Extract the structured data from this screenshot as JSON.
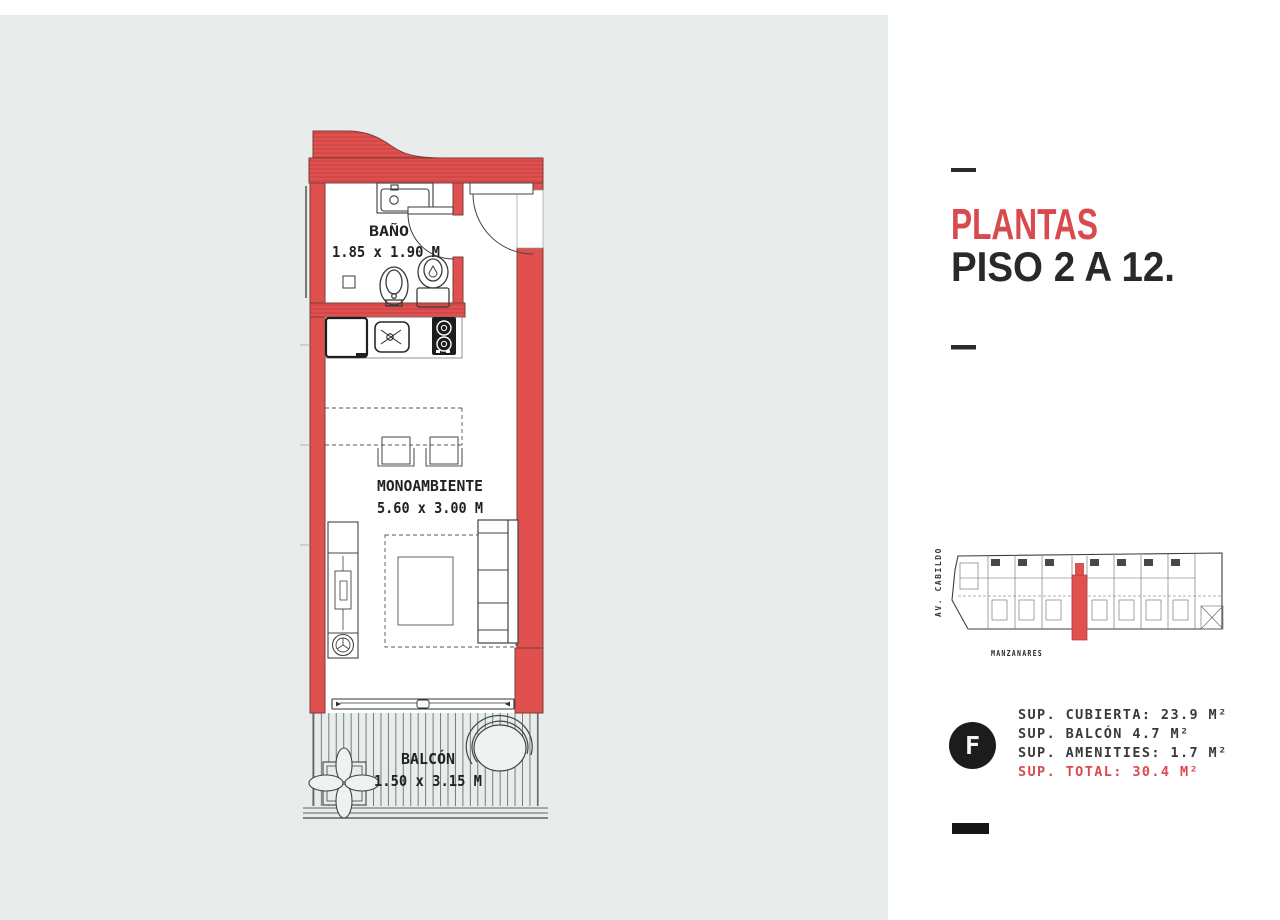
{
  "page": {
    "panel_bg": "#e8edec",
    "accent_red": "#d84a4e",
    "wall_red": "#e0504f",
    "ink": "#29292c"
  },
  "floorplan": {
    "bathroom": {
      "label": "BAÑO",
      "dims": "1.85 x 1.90 M"
    },
    "main_room": {
      "label": "MONOAMBIENTE",
      "dims": "5.60 x 3.00 M"
    },
    "balcony": {
      "label": "BALCÓN",
      "dims": "1.50 x 3.15 M"
    }
  },
  "sidebar": {
    "title": "PLANTAS",
    "subtitle": "PISO 2 A 12.",
    "unit_badge": "F",
    "key_plan": {
      "street_left": "AV. CABILDO",
      "street_bottom": "MANZANARES"
    },
    "areas": [
      {
        "label": "SUP. CUBIERTA: 23.9 M²"
      },
      {
        "label": "SUP. BALCÓN 4.7 M²"
      },
      {
        "label": "SUP. AMENITIES: 1.7 M²"
      },
      {
        "label": "SUP. TOTAL: 30.4 M²"
      }
    ]
  }
}
